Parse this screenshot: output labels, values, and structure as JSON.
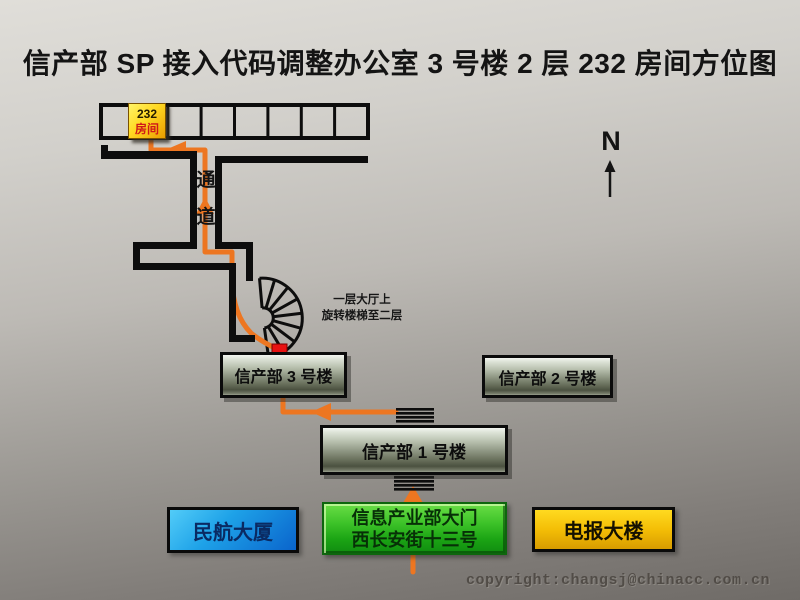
{
  "title": "信产部 SP 接入代码调整办公室 3 号楼 2 层 232 房间方位图",
  "compass": {
    "north_label": "N"
  },
  "floor_plan": {
    "room_number": "232",
    "room_label": "房间",
    "corridor_chars": [
      "通",
      "道"
    ],
    "stair_note_line1": "一层大厅上",
    "stair_note_line2": "旋转楼梯至二层"
  },
  "buildings": {
    "building3": "信产部 3 号楼",
    "building2": "信产部 2 号楼",
    "building1": "信产部 1 号楼",
    "civil_aviation": "民航大厦",
    "gate_line1": "信息产业部大门",
    "gate_line2": "西长安街十三号",
    "telegraph": "电报大楼"
  },
  "watermark": "copyright:changsj@chinacc.com.cn",
  "colors": {
    "route_orange": "#ed7621",
    "wall_black": "#0d0d0d",
    "marker_red": "#e81212",
    "room_marker_yellow": "#ffd822",
    "civil_aviation_blue": "#1ea2e8",
    "gate_green": "#3cc228",
    "telegraph_gold": "#f4be06",
    "background_gray_top": "#e0ded9",
    "background_gray_bottom": "#6f6b67"
  }
}
